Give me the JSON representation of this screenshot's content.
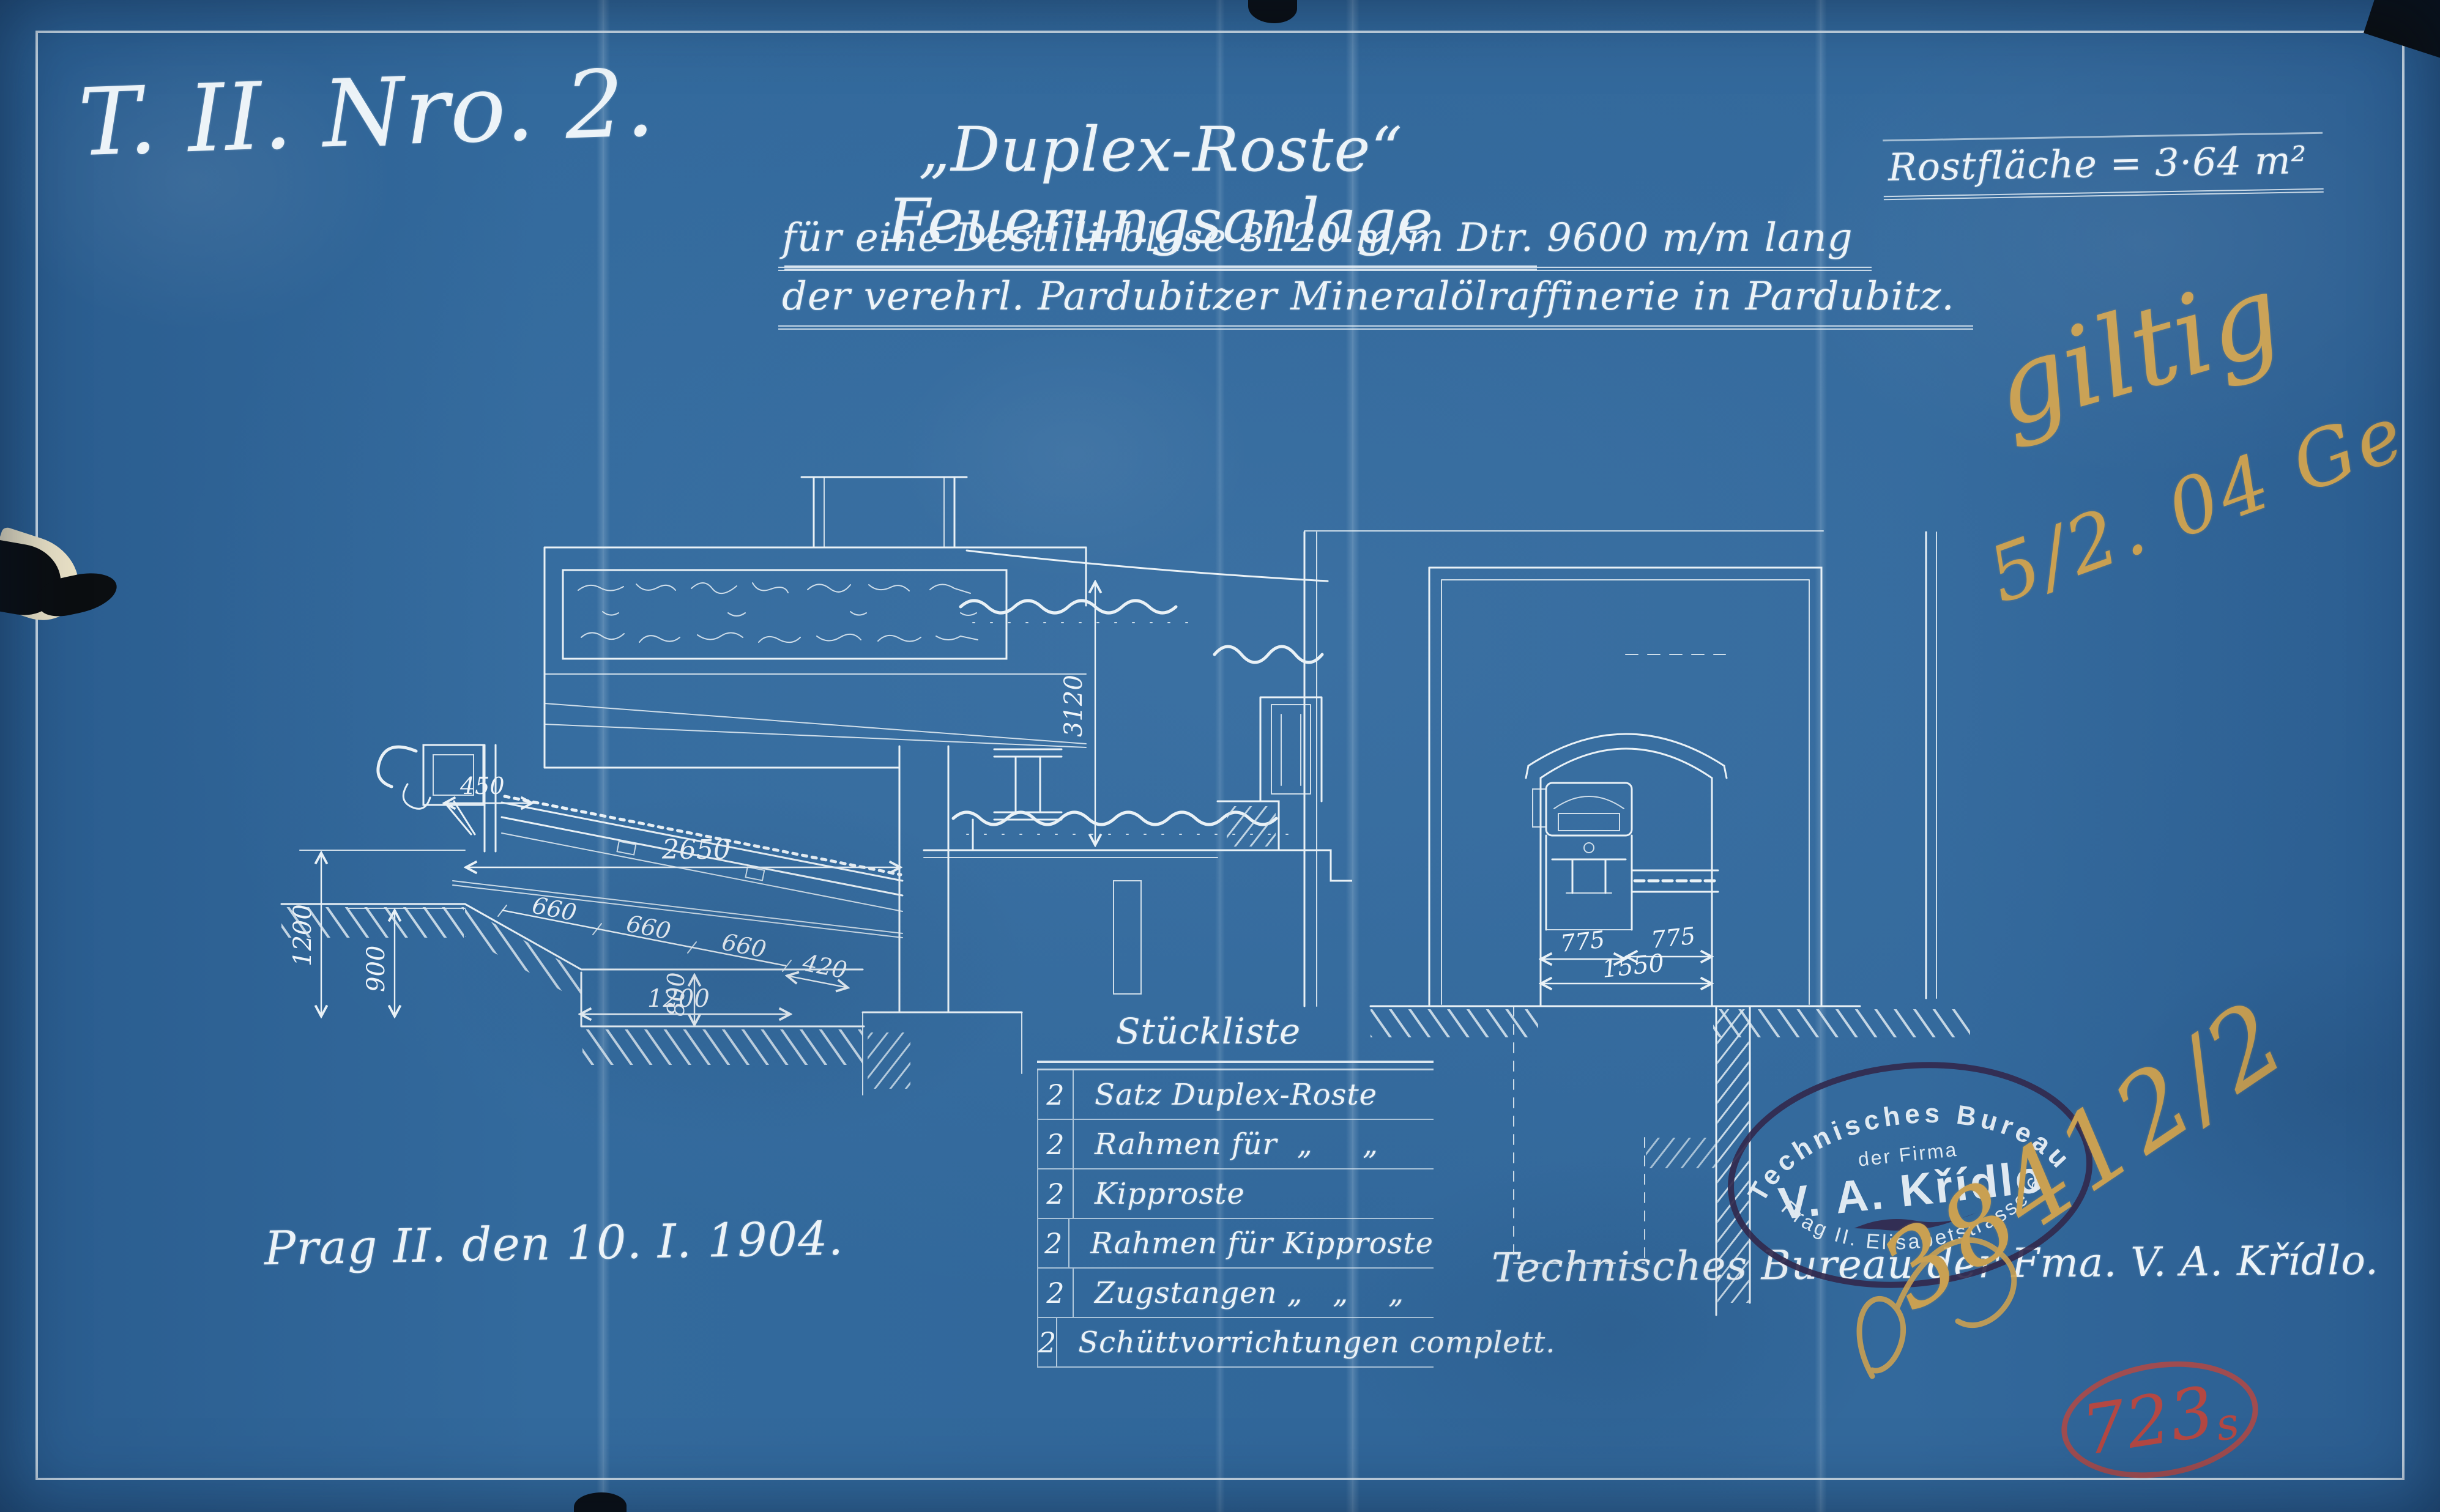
{
  "sheet": {
    "drawing_number": "T. II. Nro. 2.",
    "title": "„Duplex-Roste“ Feuerungsanlage",
    "subtitle1": "für eine Destillirblase 3120 m/m Dtr. 9600 m/m lang",
    "subtitle2": "der verehrl. Pardubitzer Mineralölraffinerie in Pardubitz.",
    "grate_area": "Rostfläche = 3·64 m²",
    "date_line": "Prag II. den 10. I. 1904.",
    "bureau_line": "Technisches Bureau der Fma. V. A. Křídlo."
  },
  "annotations": {
    "approval_word": "giltig",
    "approval_date": "5/2. 04 Ge",
    "order_number": "38412/2",
    "file_stamp_number": "723",
    "file_stamp_suffix": "s"
  },
  "stamp": {
    "line1": "Technisches Bureau",
    "line2": "der Firma",
    "line3": "V. A. Křídlo",
    "line4": "Prag II. Elisabetstrasse 6"
  },
  "parts_list": {
    "title": "Stückliste",
    "rows": [
      {
        "qty": "2",
        "name": "Satz Duplex-Roste"
      },
      {
        "qty": "2",
        "name": "Rahmen für  „     „"
      },
      {
        "qty": "2",
        "name": "Kipproste"
      },
      {
        "qty": "2",
        "name": "Rahmen für Kipproste"
      },
      {
        "qty": "2",
        "name": "Zugstangen „   „    „"
      },
      {
        "qty": "2",
        "name": "Schüttvorrichtungen complett."
      }
    ]
  },
  "dims": {
    "s450": "450",
    "s2650": "2650",
    "s660a": "660",
    "s660b": "660",
    "s660c": "660",
    "s420": "420",
    "s1200l": "1200",
    "s900": "900",
    "s800": "800",
    "s1200b": "1200",
    "s3120": "3120",
    "f775l": "775",
    "f775r": "775",
    "f1550": "1550"
  },
  "colors": {
    "paper": "#31679a",
    "line": "#e9f1f6",
    "pencil": "#c9a052",
    "red_stamp": "#c0463c",
    "ink_stamp": "#322a4e"
  }
}
